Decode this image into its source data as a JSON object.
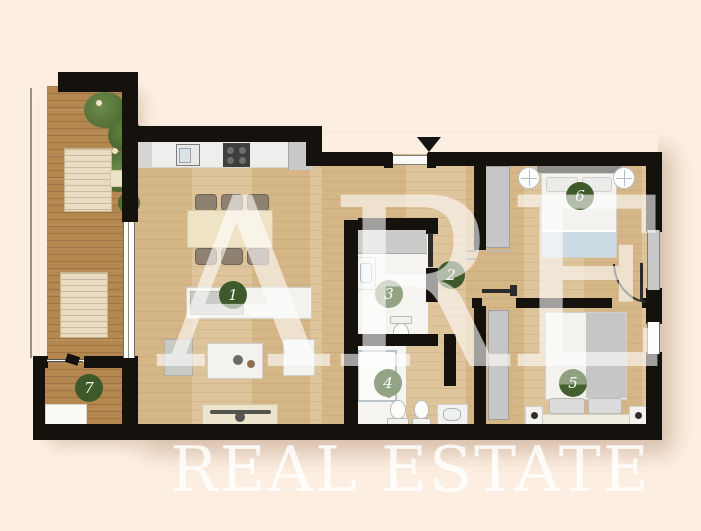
{
  "brand": {
    "monogram": "ARE",
    "wordmark": "REAL ESTATE"
  },
  "floorplan": {
    "rooms": [
      {
        "number": "1",
        "marker_color": "#3e5a2b"
      },
      {
        "number": "2",
        "marker_color": "#3e5a2b"
      },
      {
        "number": "3",
        "marker_color": "#92a483"
      },
      {
        "number": "4",
        "marker_color": "#92a483"
      },
      {
        "number": "5",
        "marker_color": "#8fa180",
        "marker_color2": "#44602f"
      },
      {
        "number": "6",
        "marker_color": "#3e5a2b"
      },
      {
        "number": "7",
        "marker_color": "#3e5a2b"
      }
    ],
    "colors": {
      "background": "#fcefe2",
      "walls": "#15120e",
      "interior_wood": "#dcc095",
      "balcony_wood": "#b3874f",
      "fixtures_gray": "#c6c6c6",
      "watermark": "#ffffff"
    }
  }
}
